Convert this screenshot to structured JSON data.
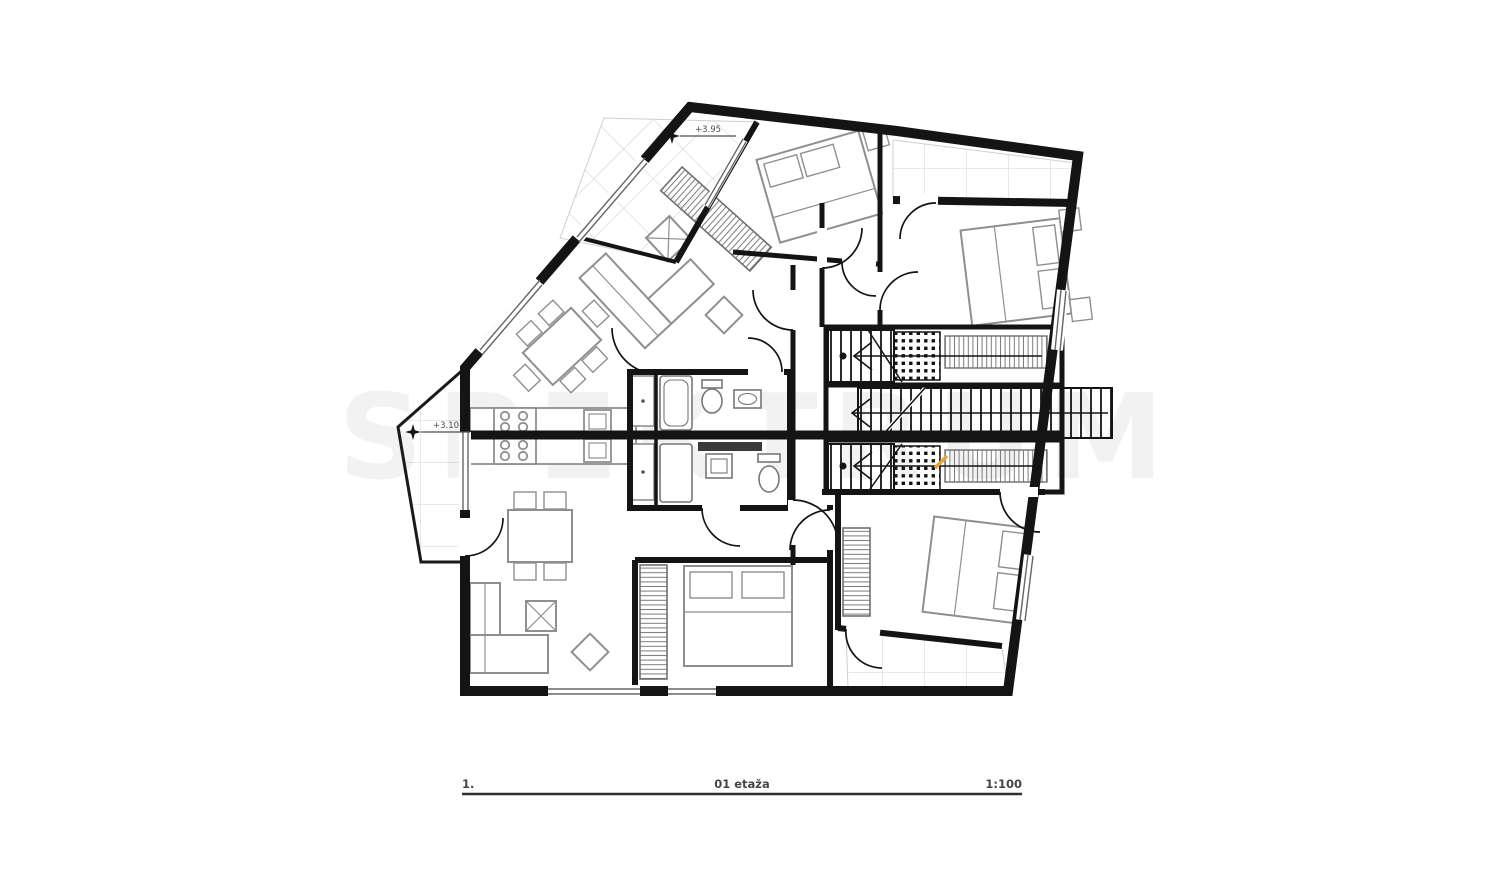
{
  "document": {
    "type": "architectural-floor-plan",
    "floor": "first floor"
  },
  "title_block": {
    "sheet_number": "1.",
    "drawing_title": "01 etaža",
    "scale": "1:100"
  },
  "elevations": {
    "upper": "+3.95",
    "lower": "+3.10"
  },
  "watermark": {
    "text": "SPEKTRUM"
  },
  "colors": {
    "wall": "#141414",
    "furniture": "#8f8f8f",
    "fixture": "#777777",
    "tile_grid": "#dcdcdc",
    "window": "#666666",
    "text": "#454545",
    "accent": "#e2a43c"
  },
  "symbols": [
    "double-bed",
    "pillow",
    "nightstand",
    "wardrobe-hatch",
    "staircase-treads",
    "stair-direction-arrow",
    "door-swing-arc",
    "window-double-line",
    "kitchen-stove",
    "kitchen-sink",
    "bathroom-shower",
    "toilet",
    "washbasin",
    "dining-table-with-chairs",
    "corner-sofa",
    "coffee-table",
    "pouf",
    "terrace-tile-grid",
    "elevation-star-marker"
  ]
}
